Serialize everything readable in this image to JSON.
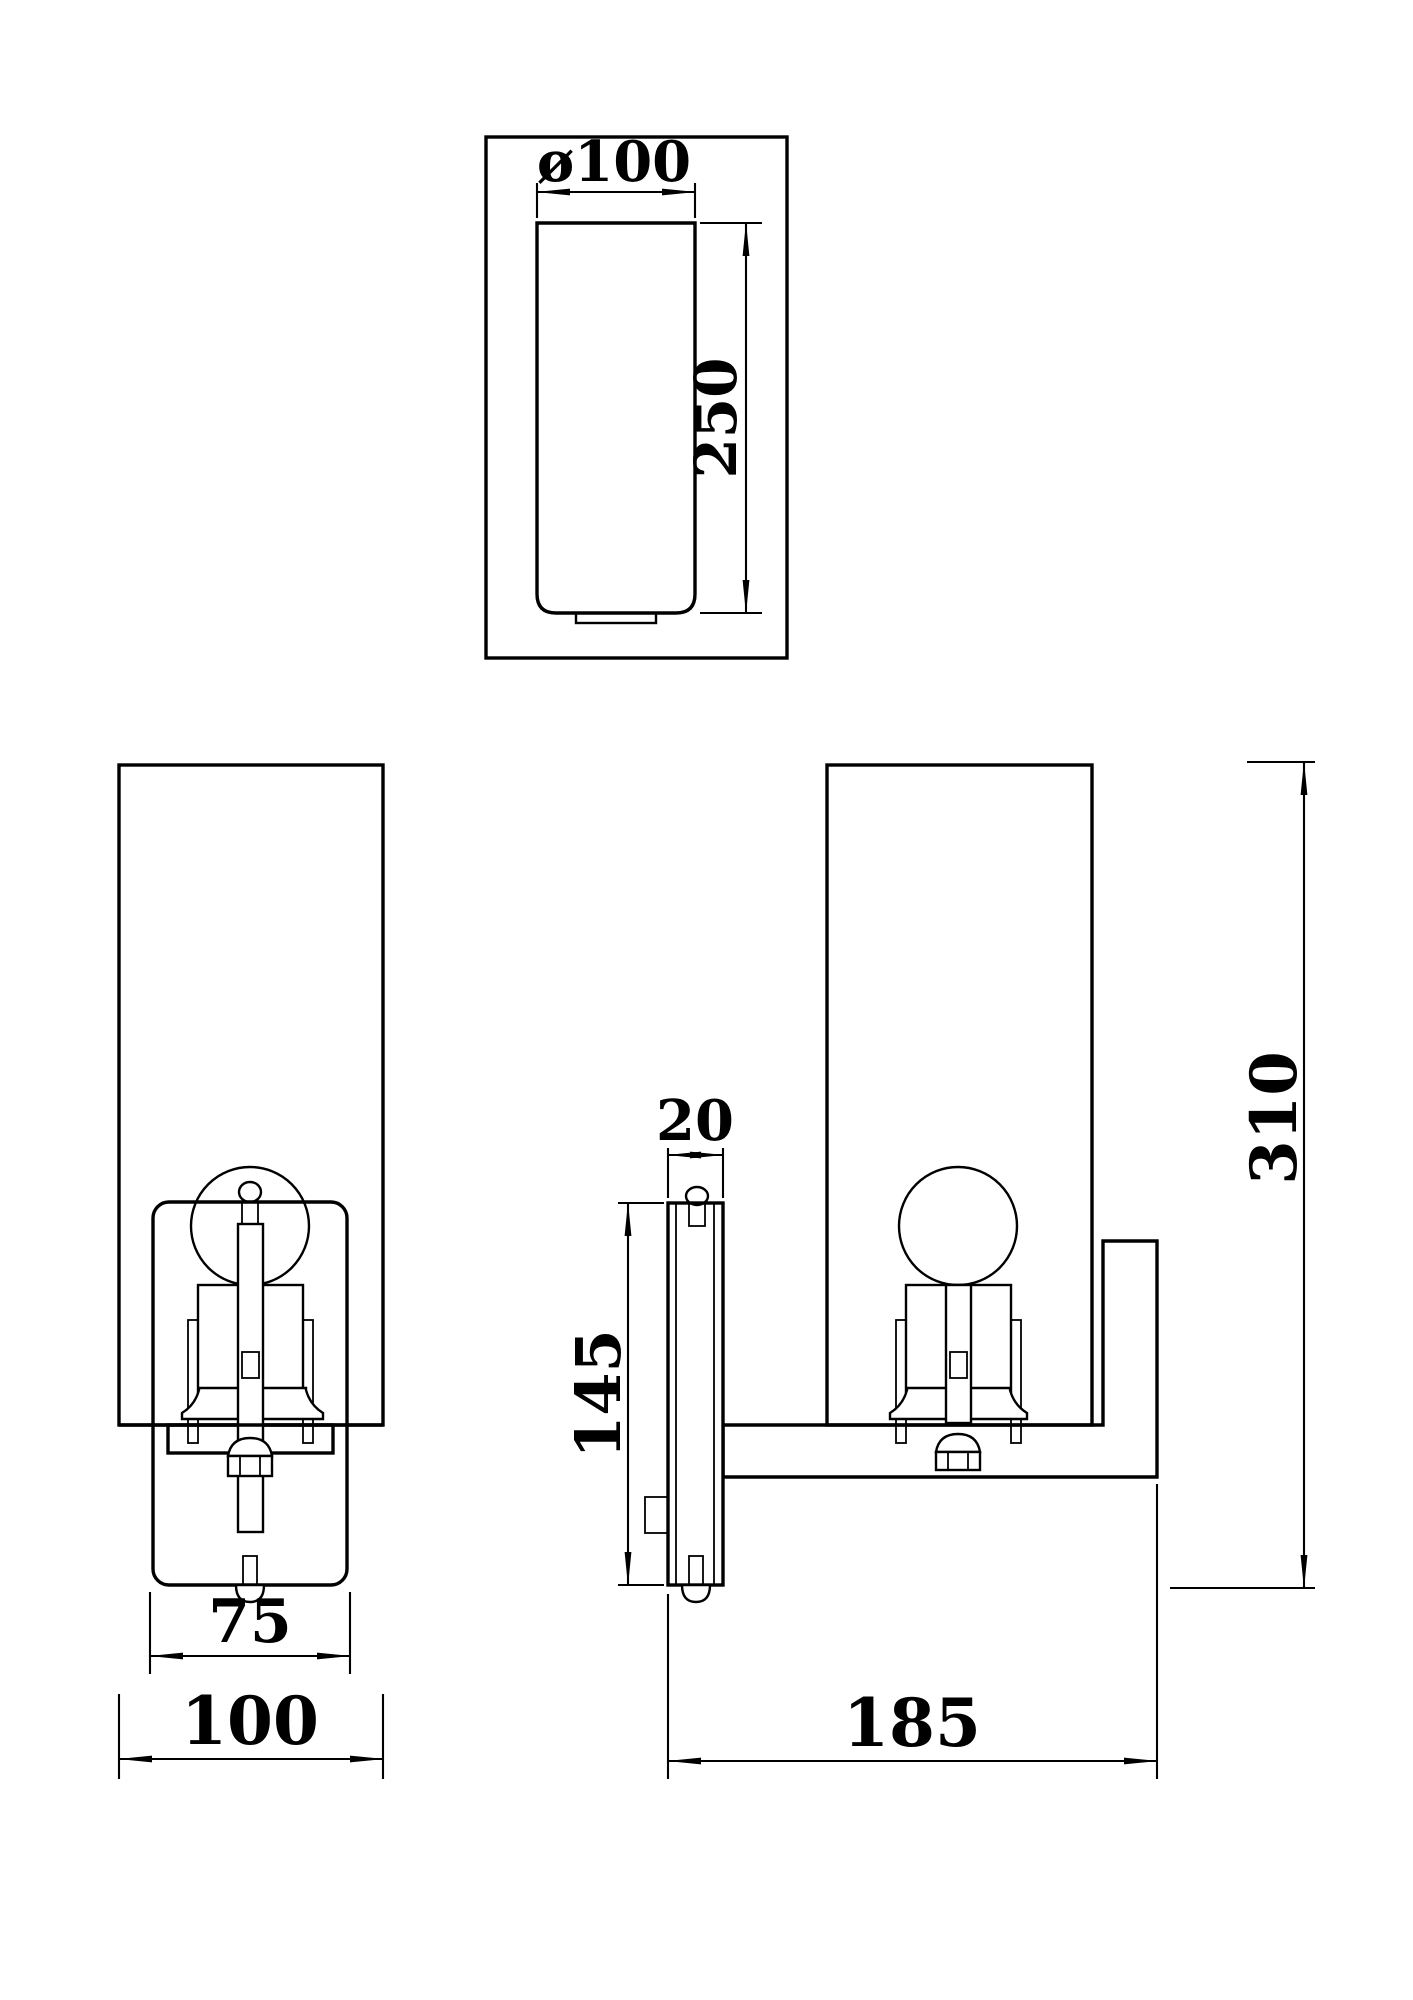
{
  "drawing": {
    "paper_color": "#ffffff",
    "ink_color": "#000000"
  },
  "dims": {
    "top_diameter": "ø100",
    "top_glass_height": "250",
    "front_backplate_width": "75",
    "front_overall_width": "100",
    "side_plate_depth": "20",
    "side_plate_height": "145",
    "side_overall_height": "310",
    "side_overall_depth": "185"
  }
}
